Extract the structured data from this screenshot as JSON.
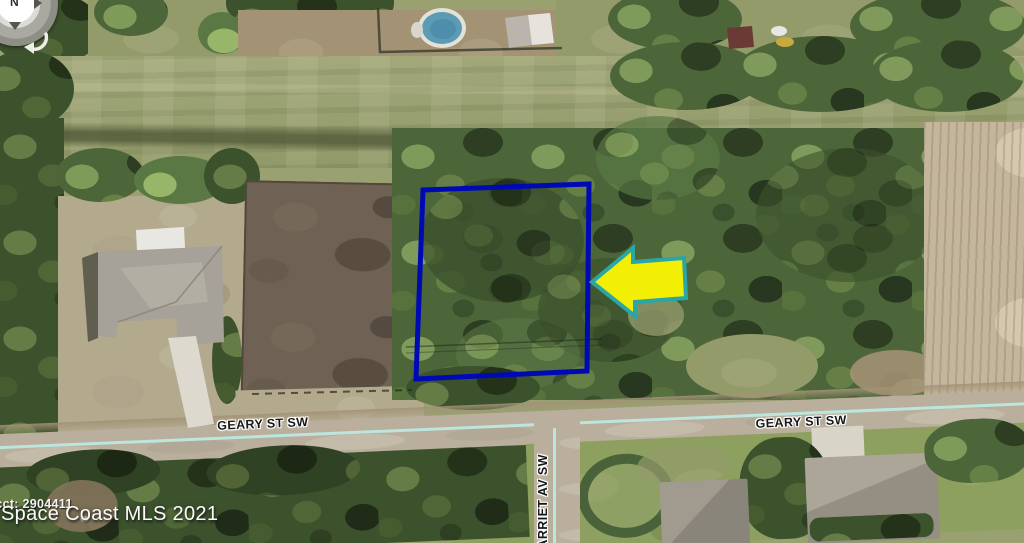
{
  "scene": {
    "type": "aerial-photo",
    "description": "Satellite view of a vacant wooded residential lot outlined in blue with a yellow arrow pointing to it"
  },
  "streets": {
    "geary_left": "GEARY ST SW",
    "geary_right": "GEARY ST SW",
    "harriet": "HARRIET AV SW"
  },
  "watermark": {
    "line1": "Acct: 2904411",
    "line2": "Space Coast MLS 2021"
  },
  "compass": {
    "north": "N"
  },
  "annotations": {
    "boundary_color": "#000ab4",
    "boundary_shape": "rectangle",
    "arrow_fill": "#f3ef04",
    "arrow_stroke": "#2aa6a6",
    "arrow_direction": "left",
    "road_centerline_color": "#bce8e2"
  }
}
